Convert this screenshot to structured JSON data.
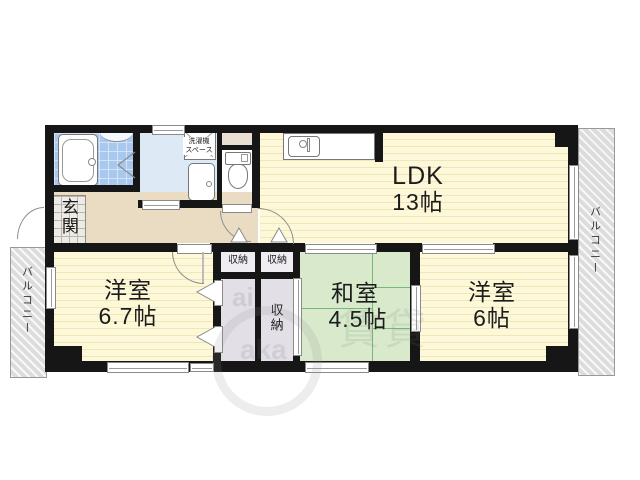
{
  "plan": {
    "rooms": {
      "ldk": {
        "name": "LDK",
        "size": "13帖"
      },
      "bedroom1": {
        "name": "洋室",
        "size": "6.7帖"
      },
      "tatami": {
        "name": "和室",
        "size": "4.5帖"
      },
      "bedroom2": {
        "name": "洋室",
        "size": "6帖"
      }
    },
    "entrance": {
      "label": "玄関"
    },
    "storage": {
      "small1": "収納",
      "small2": "収納",
      "tall": "収納"
    },
    "laundry": {
      "line1": "洗濯機",
      "line2": "スペース"
    },
    "balconies": {
      "left": "バルコニー",
      "right": "バルコニー"
    },
    "watermark": {
      "frag1": "ai",
      "frag2": "aka",
      "frag3": "賃貸"
    },
    "colors": {
      "wall": "#161616",
      "flooring": "#fdf8da",
      "flooring_stripe": "#f1e7b5",
      "tatami_green": "#d8e9cc",
      "tatami_line": "#79b879",
      "bath_tile_blue": "#a9c8ee",
      "washroom_blue": "#dde9f5",
      "hallway_beige": "#e9dcc3",
      "closet_gray": "#e3dfe7",
      "shaft_beige": "#e9dfd3",
      "balcony_gray": "#dcdcdc"
    }
  }
}
